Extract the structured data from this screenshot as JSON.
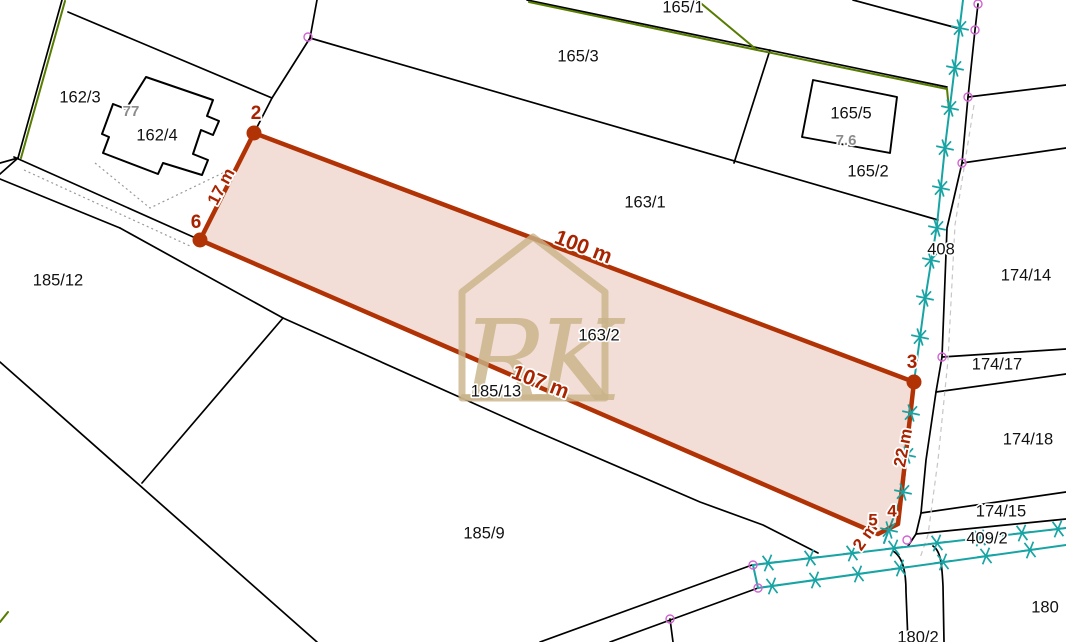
{
  "map": {
    "parcels": [
      {
        "label": "165/1"
      },
      {
        "label": "165/3"
      },
      {
        "label": "162/3"
      },
      {
        "label": "162/4"
      },
      {
        "label": "165/5"
      },
      {
        "label": "165/2"
      },
      {
        "label": "163/1"
      },
      {
        "label": "408"
      },
      {
        "label": "174/14"
      },
      {
        "label": "185/12"
      },
      {
        "label": "163/2"
      },
      {
        "label": "174/17"
      },
      {
        "label": "185/13"
      },
      {
        "label": "174/18"
      },
      {
        "label": "174/15"
      },
      {
        "label": "185/9"
      },
      {
        "label": "409/2"
      },
      {
        "label": "180"
      },
      {
        "label": "180/2"
      }
    ],
    "building_labels": [
      {
        "label": "77"
      },
      {
        "label": "7.6"
      }
    ],
    "highlighted_parcel": {
      "label": "163/2",
      "measurements": [
        {
          "text": "17 m"
        },
        {
          "text": "100 m"
        },
        {
          "text": "107 m"
        },
        {
          "text": "22 m"
        },
        {
          "text": "2 m"
        }
      ],
      "vertices": [
        {
          "number": "2"
        },
        {
          "number": "6"
        },
        {
          "number": "3"
        },
        {
          "number": "4"
        },
        {
          "number": "5"
        }
      ]
    },
    "watermark": {
      "initials": "RK"
    },
    "colors": {
      "highlight_stroke": "#b13305",
      "highlight_fill": "#f2dcd4",
      "annotation_text": "#a82300",
      "boundary_line": "#000000",
      "utility_line": "#18a4a4",
      "municipal_line": "#567c00",
      "survey_marker": "#d263d2",
      "watermark": "#c9b388",
      "parcel_text": "#111111",
      "building_text": "#8c8c8c"
    }
  }
}
